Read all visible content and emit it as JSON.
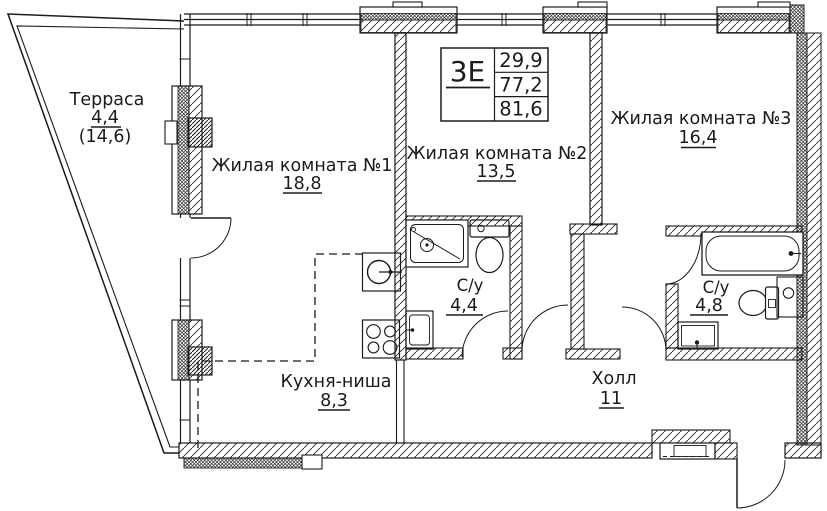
{
  "plan": {
    "unit": {
      "type": "3Е",
      "living_area": "29,9",
      "apartment_area": "77,2",
      "total_area": "81,6"
    },
    "rooms": {
      "terrace": {
        "name": "Терраса",
        "area": "4,4",
        "area_full": "(14,6)"
      },
      "room1": {
        "name": "Жилая комната №1",
        "area": "18,8"
      },
      "room2": {
        "name": "Жилая комната №2",
        "area": "13,5"
      },
      "room3": {
        "name": "Жилая комната №3",
        "area": "16,4"
      },
      "bath1": {
        "name": "С/у",
        "area": "4,4"
      },
      "bath2": {
        "name": "С/у",
        "area": "4,8"
      },
      "kitchen": {
        "name": "Кухня-ниша",
        "area": "8,3"
      },
      "hall": {
        "name": "Холл",
        "area": "11"
      }
    },
    "fixtures": [
      "shower-tray",
      "toilet",
      "washing-machine",
      "kitchen-sink",
      "stove",
      "bathtub",
      "sink"
    ],
    "colors": {
      "line": "#1b1b1b",
      "background": "#ffffff"
    }
  }
}
